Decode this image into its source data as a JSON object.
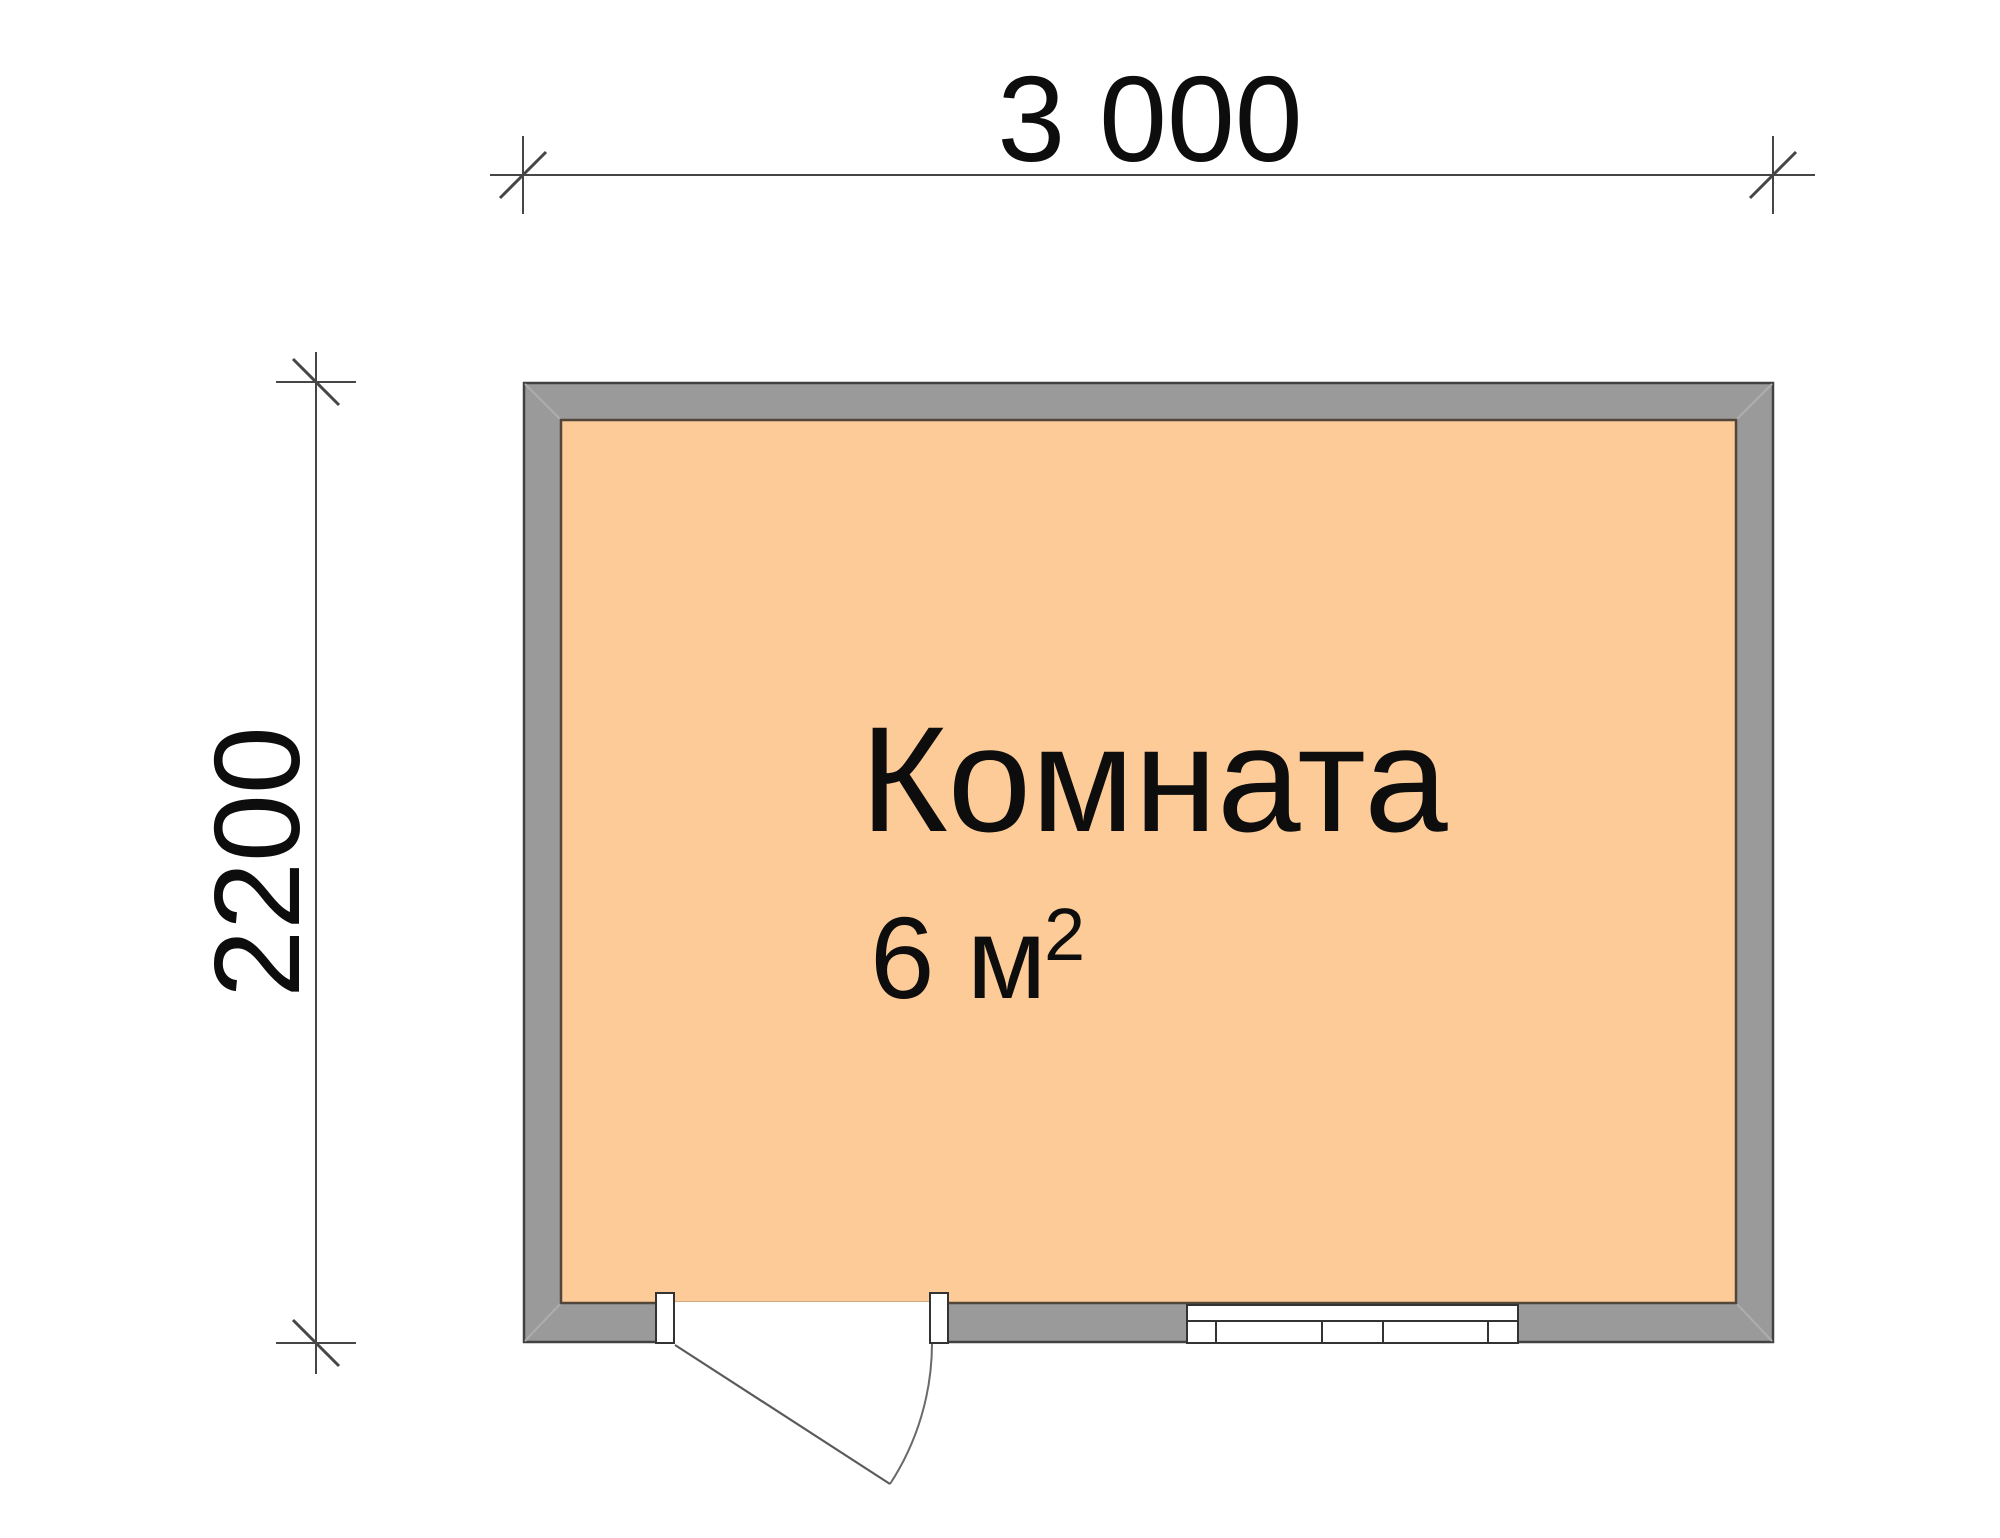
{
  "plan": {
    "dimensions": {
      "width_label": "3 000",
      "height_label": "2200"
    },
    "room": {
      "name": "Комната",
      "area_base": "6 м",
      "area_exponent": "2",
      "area_full": "6 м²"
    },
    "colors": {
      "floor_fill": "#FCCB97",
      "wall_fill": "#9A9A9A",
      "wall_outline": "#414141",
      "floor_outline": "#52453A",
      "dimension_line": "#464646",
      "text": "#0D0D0D"
    }
  }
}
